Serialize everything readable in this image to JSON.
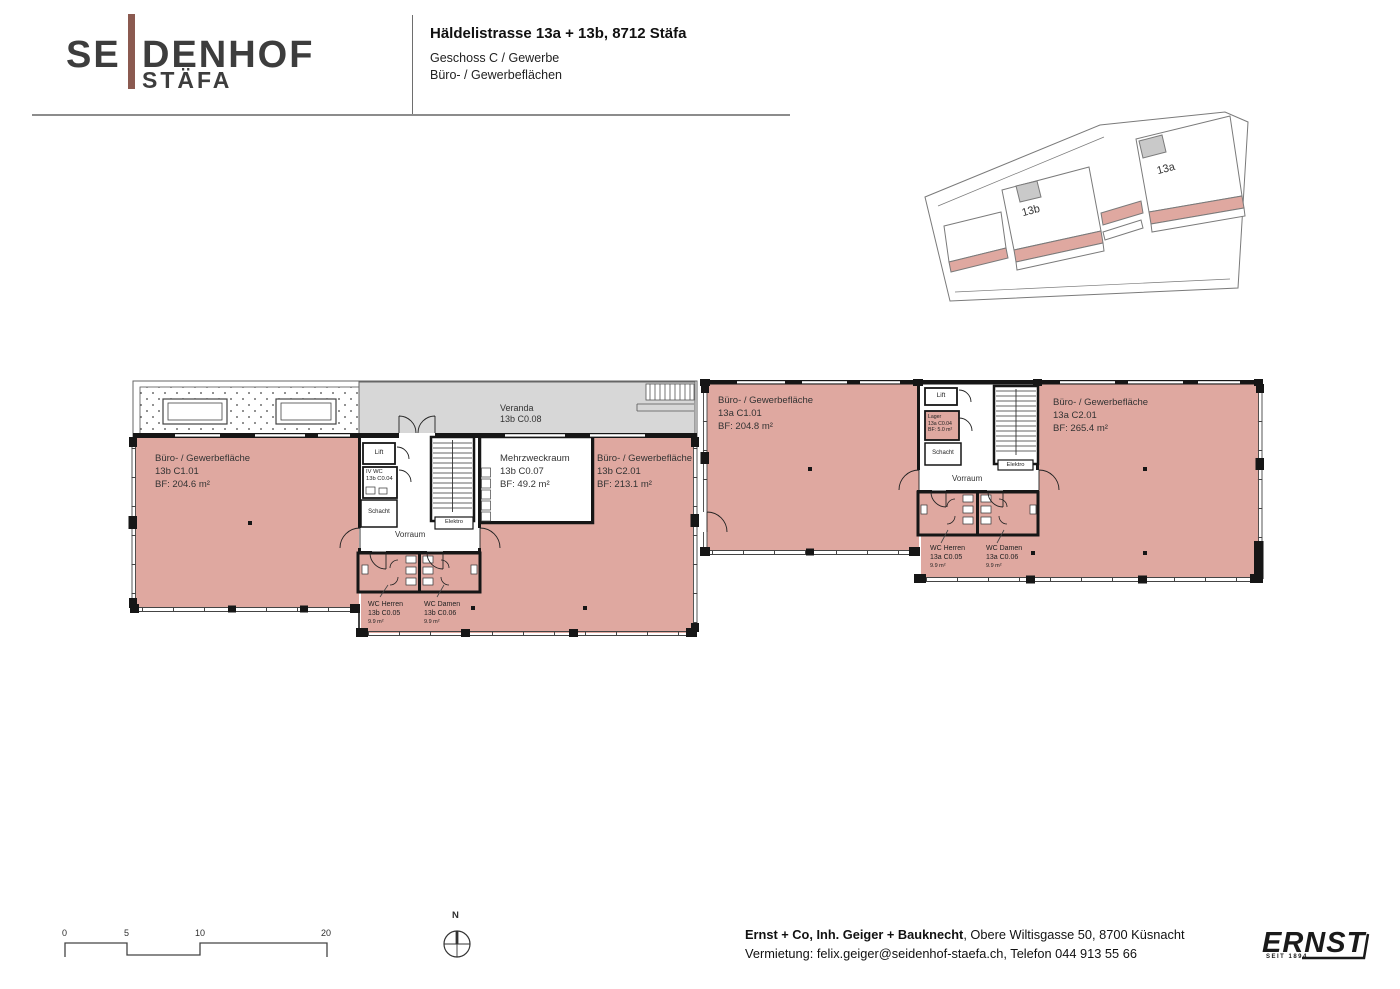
{
  "colors": {
    "room_pink": "#dfa8a0",
    "veranda_gray": "#d7d7d7",
    "logo_brown": "#8b5a50",
    "wall_ink": "#161616"
  },
  "header": {
    "logo_se": "SE",
    "logo_denhof": "DENHOF",
    "logo_staefa": "STÄFA",
    "title": "Häldelistrasse 13a + 13b, 8712 Stäfa",
    "subtitle_line1": "Geschoss C / Gewerbe",
    "subtitle_line2": "Büro- / Gewerbeflächen"
  },
  "site_plan": {
    "label_13b": "13b",
    "label_13a": "13a"
  },
  "rooms": {
    "b_c101": {
      "name": "Büro- / Gewerbefläche",
      "id": "13b C1.01",
      "area": "BF: 204.6 m²"
    },
    "b_veranda": {
      "name": "Veranda",
      "id": "13b C0.08"
    },
    "b_mehrzweck": {
      "name": "Mehrzweckraum",
      "id": "13b C0.07",
      "area": "BF: 49.2 m²"
    },
    "b_c201": {
      "name": "Büro- / Gewerbefläche",
      "id": "13b C2.01",
      "area": "BF: 213.1 m²"
    },
    "b_lift": {
      "name": "Lift"
    },
    "b_iv_wc": {
      "name": "IV WC",
      "id": "13b C0.04"
    },
    "b_schacht": {
      "name": "Schacht"
    },
    "b_elektro": {
      "name": "Elektro"
    },
    "b_vorraum": {
      "name": "Vorraum"
    },
    "b_wc_herren": {
      "name": "WC Herren",
      "id": "13b C0.05",
      "area": "9.9 m²"
    },
    "b_wc_damen": {
      "name": "WC Damen",
      "id": "13b C0.06",
      "area": "9.9 m²"
    },
    "a_c101": {
      "name": "Büro- / Gewerbefläche",
      "id": "13a C1.01",
      "area": "BF: 204.8 m²"
    },
    "a_c201": {
      "name": "Büro- / Gewerbefläche",
      "id": "13a C2.01",
      "area": "BF: 265.4 m²"
    },
    "a_lift": {
      "name": "Lift"
    },
    "a_lager": {
      "name": "Lager",
      "id": "13a C0.04",
      "area": "BF: 5.0 m²"
    },
    "a_schacht": {
      "name": "Schacht"
    },
    "a_elektro": {
      "name": "Elektro"
    },
    "a_vorraum": {
      "name": "Vorraum"
    },
    "a_wc_herren": {
      "name": "WC Herren",
      "id": "13a C0.05",
      "area": "9.9 m²"
    },
    "a_wc_damen": {
      "name": "WC Damen",
      "id": "13a C0.06",
      "area": "9.9 m²"
    }
  },
  "scale_bar": {
    "ticks": [
      "0",
      "5",
      "10",
      "20"
    ]
  },
  "compass": {
    "north": "N"
  },
  "footer": {
    "company": "Ernst + Co, Inh. Geiger + Bauknecht",
    "address": ", Obere Wiltisgasse 50, 8700 Küsnacht",
    "line2": "Vermietung: felix.geiger@seidenhof-staefa.ch, Telefon 044 913 55 66",
    "brand": "ERNST",
    "brand_sub": "SEIT 1894"
  }
}
